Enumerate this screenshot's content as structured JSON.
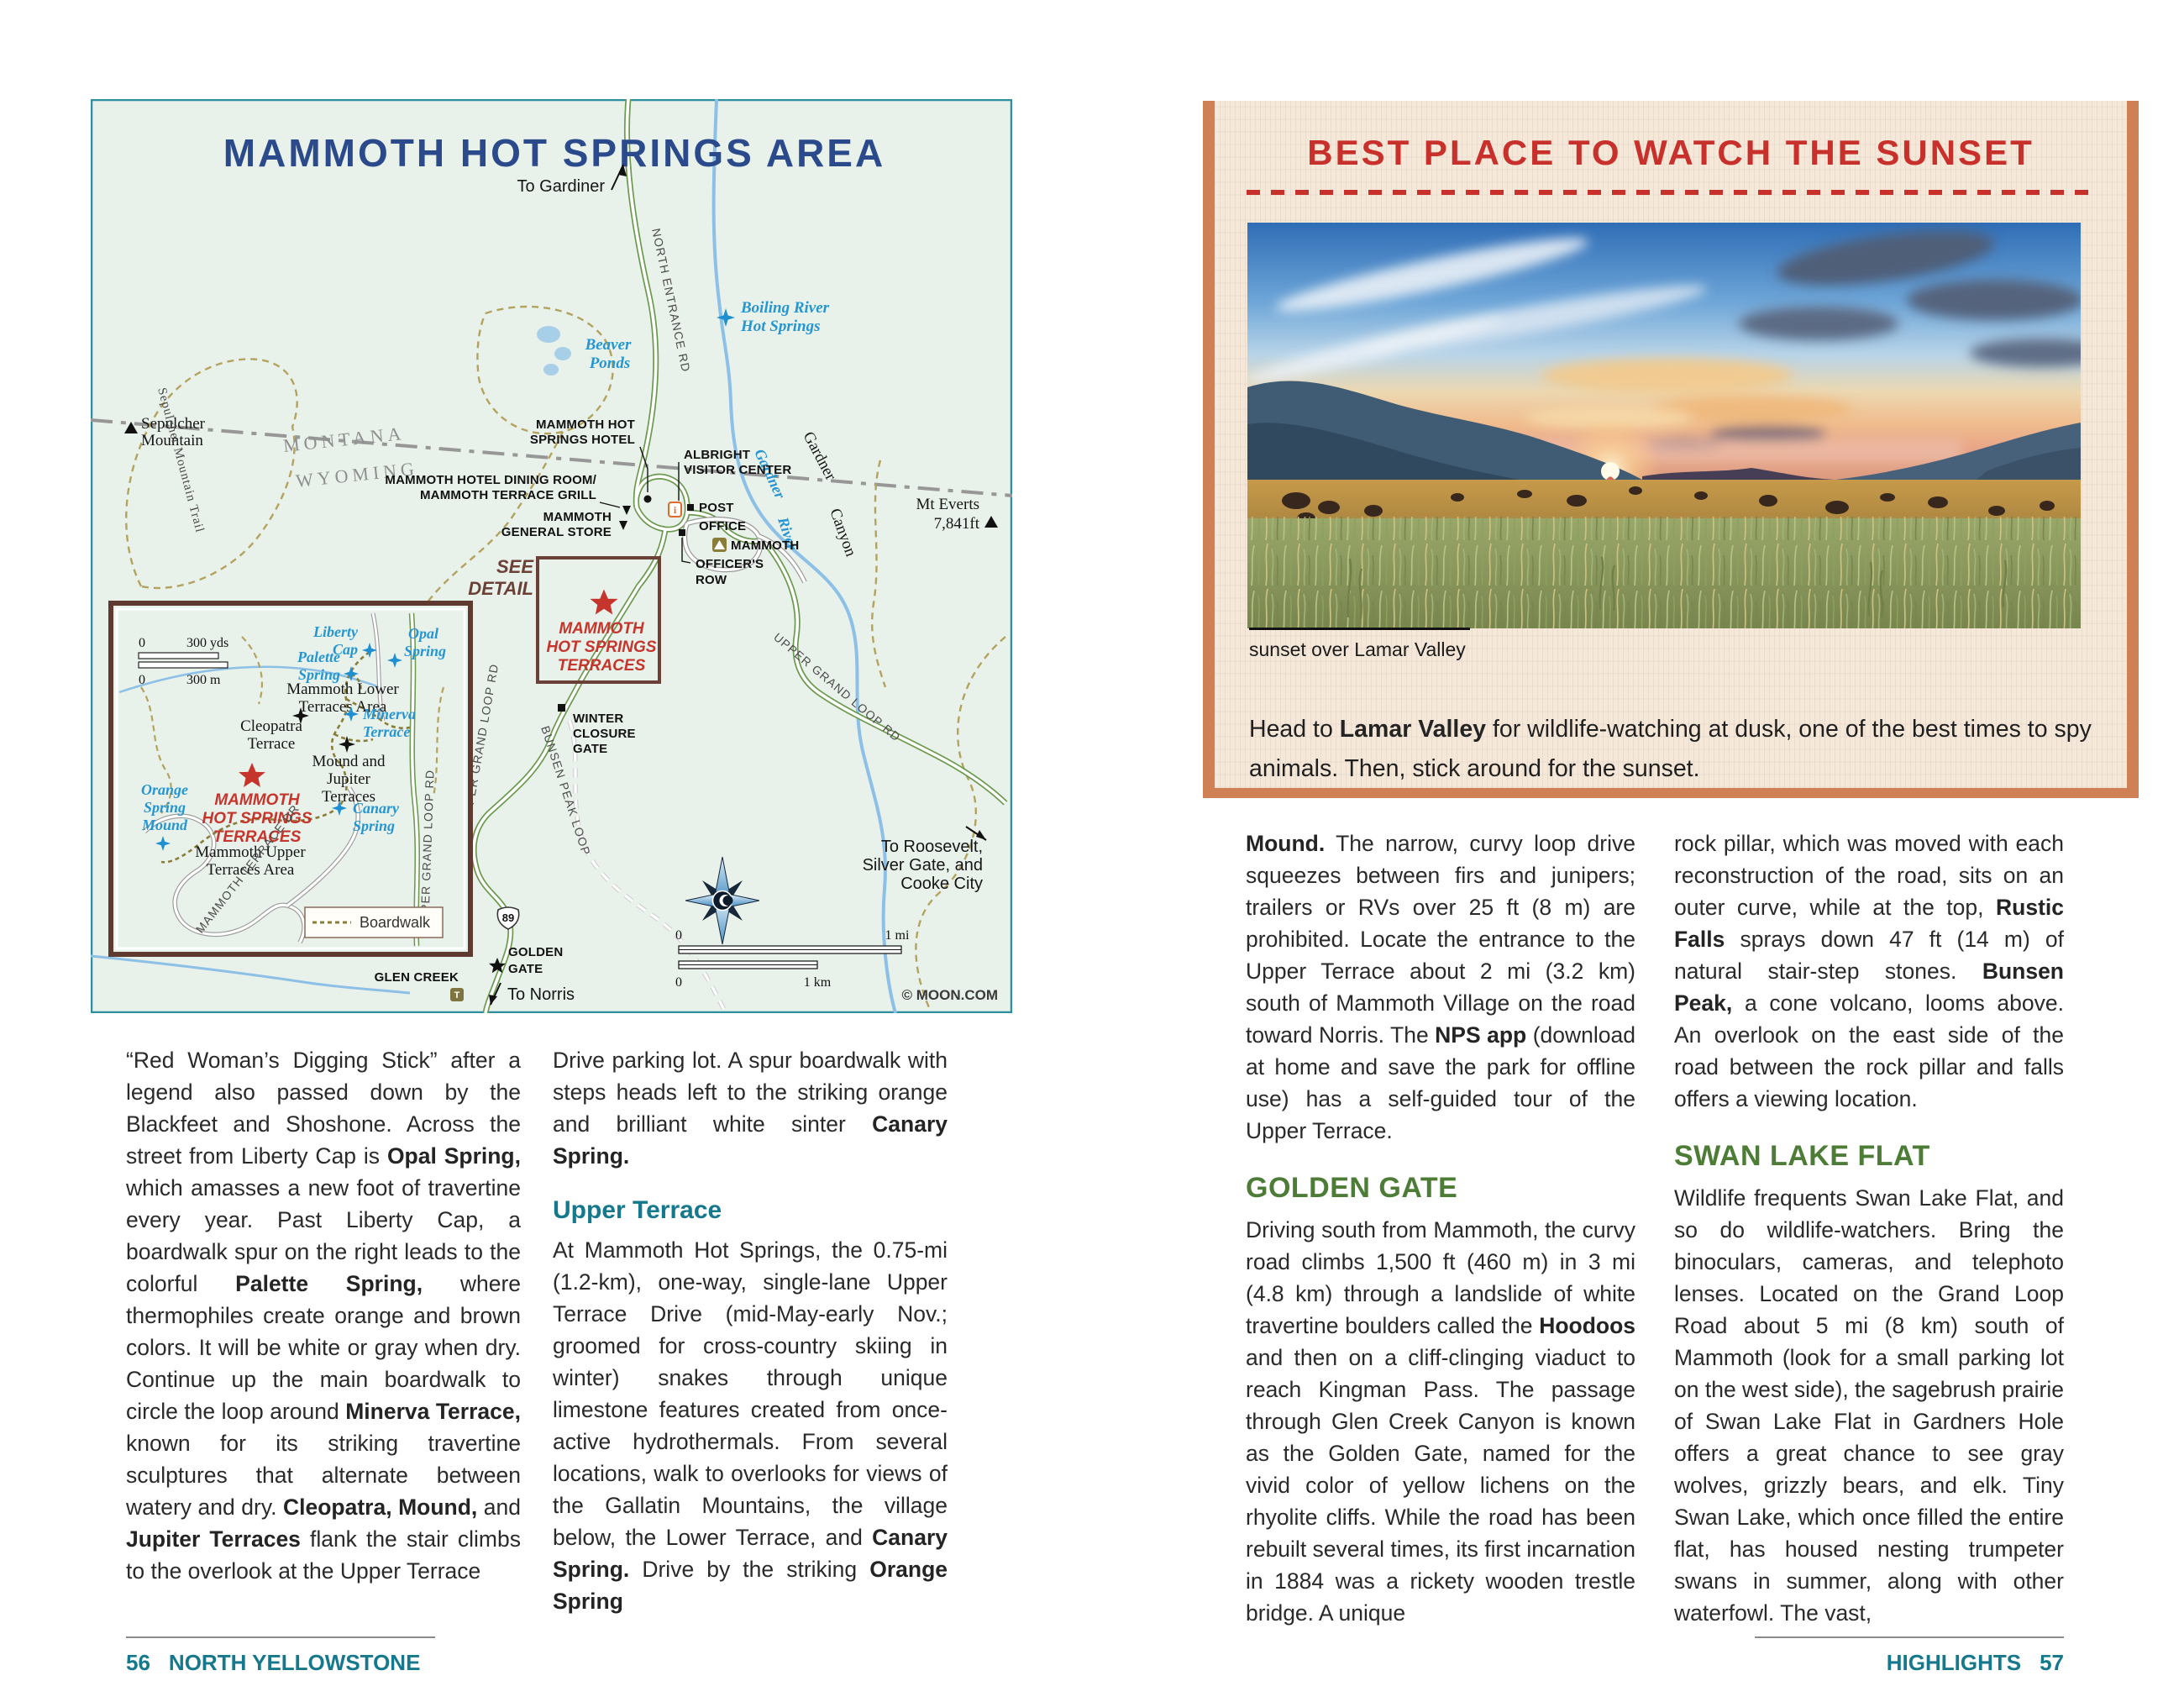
{
  "colors": {
    "accent_teal": "#15788c",
    "accent_green": "#4c7c35",
    "accent_red": "#c8302c",
    "map_navy": "#2b4a8c",
    "border_orange": "#d08055",
    "map_bg": "#e9f1eb"
  },
  "left": {
    "map": {
      "title": "MAMMOTH HOT SPRINGS AREA",
      "labels": {
        "to_gardiner": "To Gardiner",
        "north_entrance_rd": "NORTH ENTRANCE RD",
        "montana": "MONTANA",
        "wyoming": "WYOMING",
        "beaver_ponds": [
          "Beaver",
          "Ponds"
        ],
        "sepulcher": [
          "Sepulcher",
          "Mountain"
        ],
        "sepulcher_trail": "Sepulcher Mountain Trail",
        "boiling": [
          "Boiling River",
          "Hot Springs"
        ],
        "gardner_river": [
          "Gardner",
          "River"
        ],
        "gardner_canyon": [
          "Gardner",
          "Canyon"
        ],
        "mt_everts": [
          "Mt Everts",
          "7,841ft"
        ],
        "hotel": [
          "MAMMOTH HOT",
          "SPRINGS HOTEL"
        ],
        "dining": [
          "MAMMOTH HOTEL DINING ROOM/",
          "MAMMOTH TERRACE GRILL"
        ],
        "general_store": [
          "MAMMOTH",
          "GENERAL STORE"
        ],
        "albright": [
          "ALBRIGHT",
          "VISITOR CENTER"
        ],
        "post_office": [
          "POST",
          "OFFICE"
        ],
        "officers_row": [
          "OFFICER'S",
          "ROW"
        ],
        "campground": "MAMMOTH",
        "see_detail": [
          "SEE",
          "DETAIL"
        ],
        "terraces": [
          "MAMMOTH",
          "HOT SPRINGS",
          "TERRACES"
        ],
        "winter_gate": [
          "WINTER",
          "CLOSURE",
          "GATE"
        ],
        "upper_grand_loop": "UPPER GRAND LOOP RD",
        "bunsen": "BUNSEN PEAK LOOP",
        "hwy89": "89",
        "golden_gate": [
          "GOLDEN",
          "GATE"
        ],
        "glen_creek": "GLEN CREEK",
        "to_norris": "To Norris",
        "to_roosevelt": [
          "To Roosevelt,",
          "Silver Gate, and",
          "Cooke City"
        ],
        "credit": "© MOON.COM",
        "scale_mi": {
          "zero": "0",
          "one": "1 mi"
        },
        "scale_km": {
          "zero": "0",
          "one": "1 km"
        }
      },
      "inset": {
        "yds": [
          "0",
          "300 yds"
        ],
        "m": [
          "0",
          "300 m"
        ],
        "liberty": [
          "Liberty",
          "Cap"
        ],
        "opal": [
          "Opal",
          "Spring"
        ],
        "palette": [
          "Palette",
          "Spring"
        ],
        "lower": [
          "Mammoth Lower",
          "Terraces Area"
        ],
        "minerva": [
          "Minerva",
          "Terrace"
        ],
        "cleopatra": [
          "Cleopatra",
          "Terrace"
        ],
        "mound_jupiter": [
          "Mound and",
          "Jupiter",
          "Terraces"
        ],
        "orange": [
          "Orange",
          "Spring",
          "Mound"
        ],
        "canary": [
          "Canary",
          "Spring"
        ],
        "upper": [
          "Mammoth Upper",
          "Terraces Area"
        ],
        "terrace_dr": "MAMMOTH TERRACE DR",
        "boardwalk": "Boardwalk"
      }
    },
    "col1": {
      "p1": [
        {
          "t": "“Red Woman’s Digging Stick” after a legend also passed down by the Blackfeet and Shoshone. Across the street from Liberty Cap is "
        },
        {
          "t": "Opal Spring,",
          "b": true
        },
        {
          "t": " which amasses a new foot of travertine every year. Past Liberty Cap, a boardwalk spur on the right leads to the colorful "
        },
        {
          "t": "Palette Spring,",
          "b": true
        },
        {
          "t": " where thermophiles create orange and brown colors. It will be white or gray when dry. Continue up the main boardwalk to circle the loop around "
        },
        {
          "t": "Minerva Terrace,",
          "b": true
        },
        {
          "t": " known for its striking travertine sculptures that alternate between watery and dry. "
        },
        {
          "t": "Cleopatra, Mound,",
          "b": true
        },
        {
          "t": " and "
        },
        {
          "t": "Jupiter Terraces",
          "b": true
        },
        {
          "t": " flank the stair climbs to the overlook at the Upper Terrace"
        }
      ]
    },
    "col2": {
      "p1": [
        {
          "t": "Drive parking lot. A spur boardwalk with steps heads left to the striking orange and brilliant white sinter "
        },
        {
          "t": "Canary Spring.",
          "b": true
        }
      ],
      "h": "Upper Terrace",
      "p2": [
        {
          "t": "At Mammoth Hot Springs, the 0.75-mi (1.2-km), one-way, single-lane Upper Terrace Drive (mid-May-early Nov.; groomed for cross-country skiing in winter) snakes through unique limestone features created from once-active hydrothermals. From several locations, walk to overlooks for views of the Gallatin Mountains, the village below, the Lower Terrace, and "
        },
        {
          "t": "Canary Spring.",
          "b": true
        },
        {
          "t": " Drive by the striking "
        },
        {
          "t": "Orange Spring",
          "b": true
        }
      ]
    },
    "footer": {
      "num": "56",
      "label": "NORTH YELLOWSTONE"
    }
  },
  "right": {
    "feature": {
      "title": "BEST PLACE TO WATCH THE SUNSET",
      "caption": "sunset over Lamar Valley",
      "lede": [
        {
          "t": "Head to "
        },
        {
          "t": "Lamar Valley",
          "b": true
        },
        {
          "t": " for wildlife-watching at dusk, one of the best times to spy animals. Then, stick around for the sunset."
        }
      ]
    },
    "col1": {
      "p1": [
        {
          "t": "Mound.",
          "b": true
        },
        {
          "t": " The narrow, curvy loop drive squeezes between firs and junipers; trailers or RVs over 25 ft (8 m) are prohibited. Locate the entrance to the Upper Terrace about 2 mi (3.2 km) south of Mammoth Village on the road toward Norris. The "
        },
        {
          "t": "NPS app",
          "b": true
        },
        {
          "t": " (download at home and save the park for offline use) has a self-guided tour of the Upper Terrace."
        }
      ],
      "h": "GOLDEN GATE",
      "p2": [
        {
          "t": "Driving south from Mammoth, the curvy road climbs 1,500 ft (460 m) in 3 mi (4.8 km) through a landslide of white travertine boulders called the "
        },
        {
          "t": "Hoodoos",
          "b": true
        },
        {
          "t": " and then on a cliff-clinging viaduct to reach Kingman Pass. The passage through Glen Creek Canyon is known as the Golden Gate, named for the vivid color of yellow lichens on the rhyolite cliffs. While the road has been rebuilt several times, its first incarnation in 1884 was a rickety wooden trestle bridge. A unique"
        }
      ]
    },
    "col2": {
      "p1": [
        {
          "t": "rock pillar, which was moved with each reconstruction of the road, sits on an outer curve, while at the top, "
        },
        {
          "t": "Rustic Falls",
          "b": true
        },
        {
          "t": " sprays down 47 ft (14 m) of natural stair-step stones. "
        },
        {
          "t": "Bunsen Peak,",
          "b": true
        },
        {
          "t": " a cone volcano, looms above. An overlook on the east side of the road between the rock pillar and falls offers a viewing location."
        }
      ],
      "h": "SWAN LAKE FLAT",
      "p2": [
        {
          "t": "Wildlife frequents Swan Lake Flat, and so do wildlife-watchers. Bring the binoculars, cameras, and telephoto lenses. Located on the Grand Loop Road about 5 mi (8 km) south of Mammoth (look for a small parking lot on the west side), the sagebrush prairie of Swan Lake Flat in Gardners Hole offers a great chance to see gray wolves, grizzly bears, and elk. Tiny Swan Lake, which once filled the entire flat, has housed nesting trumpeter swans in summer, along with other waterfowl. The vast,"
        }
      ]
    },
    "footer": {
      "label": "HIGHLIGHTS",
      "num": "57"
    }
  }
}
